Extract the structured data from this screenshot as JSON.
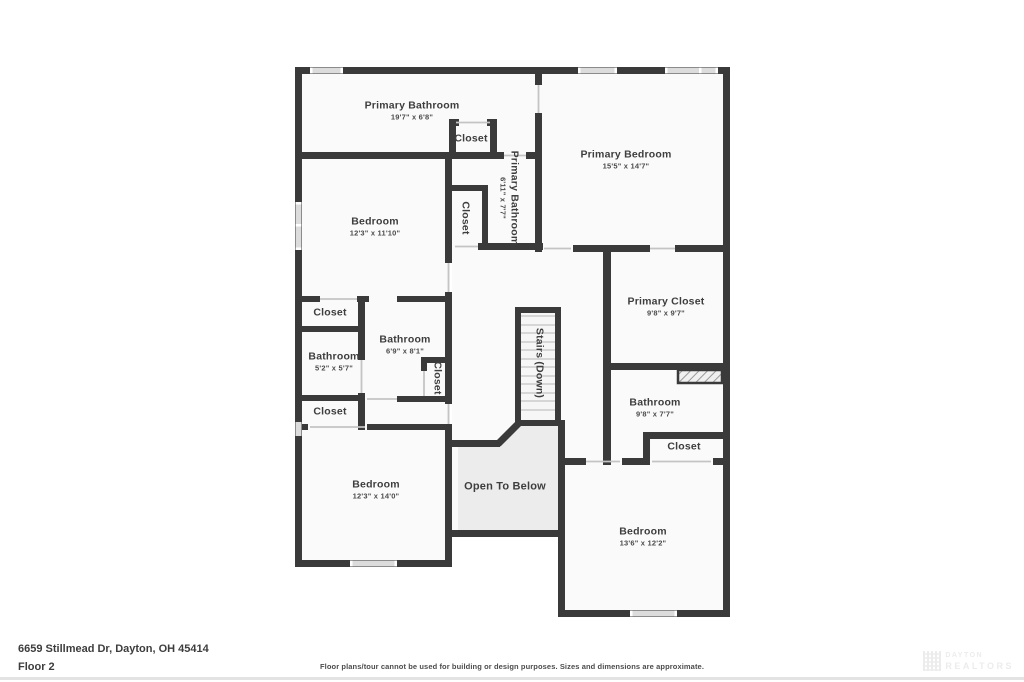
{
  "plan": {
    "wall_color": "#3a3a3a",
    "room_fill": "#fafafa",
    "open_area_fill": "#ececec",
    "window_fill": "#dcdcdc",
    "rooms": [
      {
        "id": "primary-bathroom-top",
        "name": "Primary Bathroom",
        "dims": "19'7\" x 6'8\""
      },
      {
        "id": "closet-top",
        "name": "Closet",
        "dims": ""
      },
      {
        "id": "primary-bedroom",
        "name": "Primary Bedroom",
        "dims": "15'5\" x 14'7\""
      },
      {
        "id": "primary-bathroom-inner",
        "name": "Primary Bathroom",
        "dims": "6'11\" x 7'7\""
      },
      {
        "id": "closet-inner-top",
        "name": "Closet",
        "dims": ""
      },
      {
        "id": "bedroom-upper-left",
        "name": "Bedroom",
        "dims": "12'3\" x 11'10\""
      },
      {
        "id": "closet-mid-1",
        "name": "Closet",
        "dims": ""
      },
      {
        "id": "bathroom-small",
        "name": "Bathroom",
        "dims": "5'2\" x 5'7\""
      },
      {
        "id": "bathroom-mid",
        "name": "Bathroom",
        "dims": "6'9\" x 8'1\""
      },
      {
        "id": "closet-mid-vertical",
        "name": "Closet",
        "dims": ""
      },
      {
        "id": "closet-mid-2",
        "name": "Closet",
        "dims": ""
      },
      {
        "id": "primary-closet",
        "name": "Primary Closet",
        "dims": "9'8\" x 9'7\""
      },
      {
        "id": "stairs",
        "name": "Stairs (Down)",
        "dims": ""
      },
      {
        "id": "bathroom-right",
        "name": "Bathroom",
        "dims": "9'8\" x 7'7\""
      },
      {
        "id": "closet-right",
        "name": "Closet",
        "dims": ""
      },
      {
        "id": "bedroom-bottom-left",
        "name": "Bedroom",
        "dims": "12'3\" x 14'0\""
      },
      {
        "id": "open-to-below",
        "name": "Open To Below",
        "dims": ""
      },
      {
        "id": "bedroom-bottom-right",
        "name": "Bedroom",
        "dims": "13'6\" x 12'2\""
      }
    ]
  },
  "footer": {
    "address": "6659 Stillmead Dr, Dayton, OH 45414",
    "floor_label": "Floor 2",
    "disclaimer": "Floor plans/tour cannot be used for building or design purposes. Sizes and dimensions are approximate.",
    "watermark_line1": "DAYTON",
    "watermark_line2": "REALTORS"
  }
}
